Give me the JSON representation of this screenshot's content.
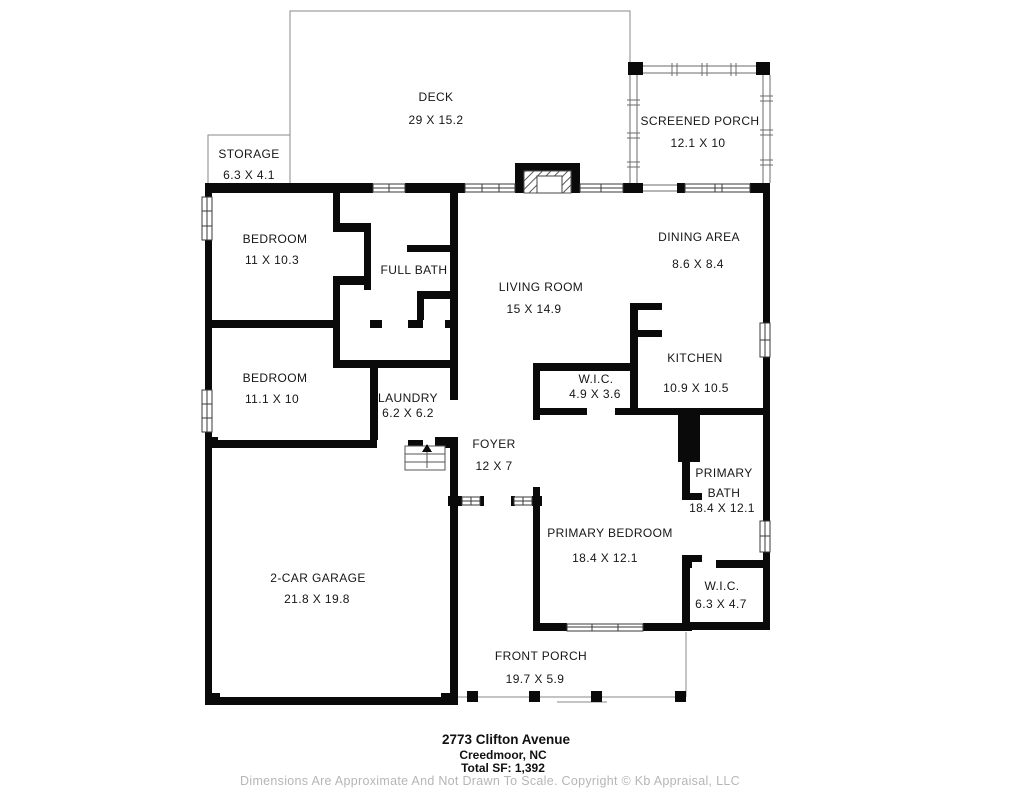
{
  "plan": {
    "type": "residential-floor-plan",
    "rooms": [
      {
        "id": "deck",
        "name": "DECK",
        "dims": "29 X 15.2"
      },
      {
        "id": "storage",
        "name": "STORAGE",
        "dims": "6.3 X 4.1"
      },
      {
        "id": "screened-porch",
        "name": "SCREENED PORCH",
        "dims": "12.1 X 10"
      },
      {
        "id": "bedroom-1",
        "name": "BEDROOM",
        "dims": "11 X 10.3"
      },
      {
        "id": "full-bath",
        "name": "FULL BATH",
        "dims": ""
      },
      {
        "id": "living-room",
        "name": "LIVING ROOM",
        "dims": "15 X 14.9"
      },
      {
        "id": "dining-area",
        "name": "DINING AREA",
        "dims": "8.6 X 8.4"
      },
      {
        "id": "kitchen",
        "name": "KITCHEN",
        "dims": "10.9 X 10.5"
      },
      {
        "id": "wic-hall",
        "name": "W.I.C.",
        "dims": "4.9 X 3.6"
      },
      {
        "id": "bedroom-2",
        "name": "BEDROOM",
        "dims": "11.1 X 10"
      },
      {
        "id": "laundry",
        "name": "LAUNDRY",
        "dims": "6.2 X 6.2"
      },
      {
        "id": "foyer",
        "name": "FOYER",
        "dims": "12 X 7"
      },
      {
        "id": "primary-bath",
        "name": "PRIMARY BATH",
        "dims": "18.4 X 12.1"
      },
      {
        "id": "primary-bedroom",
        "name": "PRIMARY BEDROOM",
        "dims": "18.4 X 12.1"
      },
      {
        "id": "wic-primary",
        "name": "W.I.C.",
        "dims": "6.3 X 4.7"
      },
      {
        "id": "garage",
        "name": "2-CAR GARAGE",
        "dims": "21.8 X 19.8"
      },
      {
        "id": "front-porch",
        "name": "FRONT PORCH",
        "dims": "19.7 X 5.9"
      }
    ],
    "footer": {
      "address_line1": "2773 Clifton Avenue",
      "address_line2": "Creedmoor, NC",
      "total_sf": "Total SF: 1,392",
      "disclaimer": "Dimensions Are Approximate And Not Drawn To Scale. Copyright © Kb Appraisal, LLC"
    },
    "colors": {
      "wall": "#0a0a0a",
      "thin_line": "#8a8a8a",
      "label_text": "#161616",
      "muted_text": "#b6b6b6"
    }
  }
}
